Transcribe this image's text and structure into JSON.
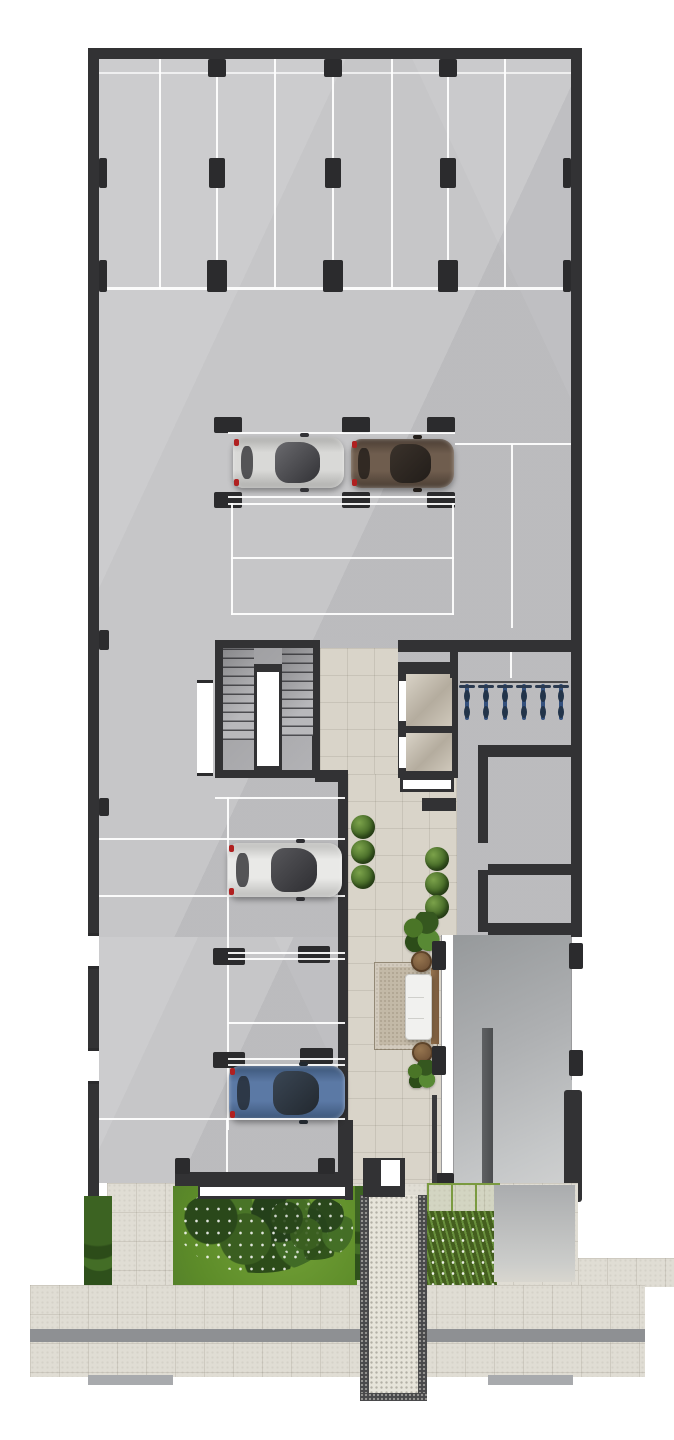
{
  "document": {
    "kind": "architectural floor plan",
    "view": "top-down render, residential building ground floor with garage, core and front garden",
    "visible_text": "none"
  },
  "palette": {
    "wall": "#323234",
    "concrete_floor": "#c6c6c8",
    "lobby_pavers": "#d9d4c9",
    "outdoor_pavers": "#e0ddd4",
    "parking_marking": "#ffffff",
    "lawn": "#679632",
    "shrub": "#31511d",
    "driveway": "#a4a6a8",
    "rug": "#c3b9a7",
    "wood_console": "#8a6a49",
    "elevator_cab": "#cfc7b9",
    "car_silver": "#d9d9d7",
    "car_bronze": "#6f5d4e",
    "car_white_suv": "#e9e9e7",
    "car_blue": "#5b79a5",
    "bike_blue": "#33507d",
    "tactile_strip": "#8e9093"
  },
  "labels": {
    "garage": "Parking garage",
    "top_stalls": "Parking stall row (8 stalls)",
    "mid_stalls": "Central parking stalls",
    "side_stalls": "Side parking stalls",
    "stairwell": "Stairwell core",
    "elevators": "Elevator bank (2 cabs)",
    "bikes": "Bicycle parking (6 bikes)",
    "storage": "Storage / technical rooms",
    "lobby": "Entrance lobby",
    "sofa": "Lobby sofa",
    "rug": "Area rug",
    "driveway": "Car driveway ramp",
    "walkway": "Entrance walkway",
    "garden": "Front garden",
    "lawn": "Lawn",
    "flower_bed": "Flower bed planter",
    "hedge": "Hedge row",
    "sidewalk": "Public sidewalk",
    "tactile": "Paving accent strip",
    "entrance_glass": "Glazed entrance",
    "columns": "Structural column"
  },
  "inventory": {
    "top_parking_stalls": 8,
    "central_parking_stalls": 4,
    "left_side_parking_stalls": 5,
    "right_side_parking_stalls": 2,
    "cars": [
      {
        "color_name": "silver hatchback",
        "location": "central stall row"
      },
      {
        "color_name": "dark bronze sedan",
        "location": "central stall row"
      },
      {
        "color_name": "white SUV",
        "location": "left side stalls"
      },
      {
        "color_name": "steel blue hatchback",
        "location": "left side stalls"
      }
    ],
    "elevator_count": 2,
    "bicycle_count": 6,
    "lobby_round_planters": 6,
    "lobby_large_plants": 3,
    "side_tables": 2,
    "structural_column_count": 22
  }
}
